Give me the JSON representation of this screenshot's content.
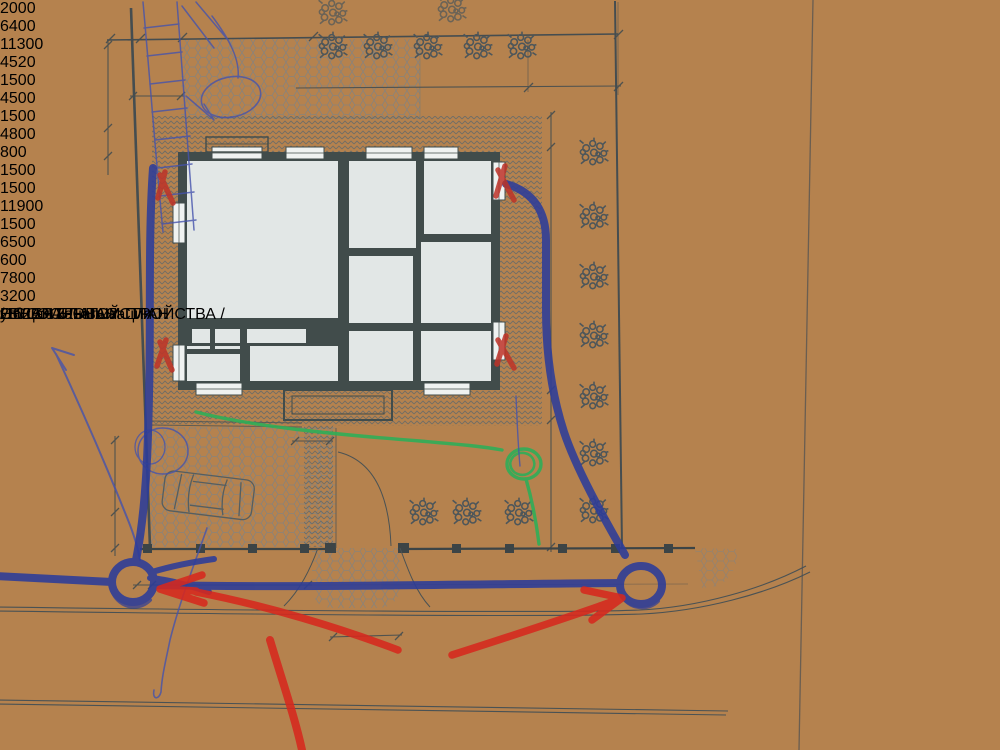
{
  "sheet": {
    "title_main": "ГЕНЕРАЛЬНЫЙ  ПЛАН",
    "title_sub": "/  ПЛАН  БЛАГОУСТРОЙСТВА  /",
    "street_label": "ул.  СОСНОВАЯ"
  },
  "dims": {
    "top_left_width": "2000",
    "top_house_width": "6400",
    "upper_width": "11300",
    "upper_right_width": "4520",
    "strip_width": "1500",
    "left_height": "4500",
    "left_height2": "1500",
    "drive_height": "4800",
    "drive_offset": "800",
    "walk_width": "1500",
    "right_top": "1500",
    "right_main": "11900",
    "right_mid": "1500",
    "right_lower": "6500",
    "well_offset": "600",
    "sewer_run": "7800",
    "gate_width": "3200"
  },
  "annotations": {
    "pen_note": "Н ?",
    "red_note": "Общая канализация",
    "timestamp": "28 23:07"
  },
  "colors": {
    "paper": "#e3e8e9",
    "wood": "#bb8650",
    "print_ink": "#454d50",
    "pen_blue": "#3f4db3",
    "marker_blue": "#2c3c9a",
    "marker_green": "#2fae58",
    "marker_red": "#d6281e",
    "stamp_red": "#ff5517"
  }
}
